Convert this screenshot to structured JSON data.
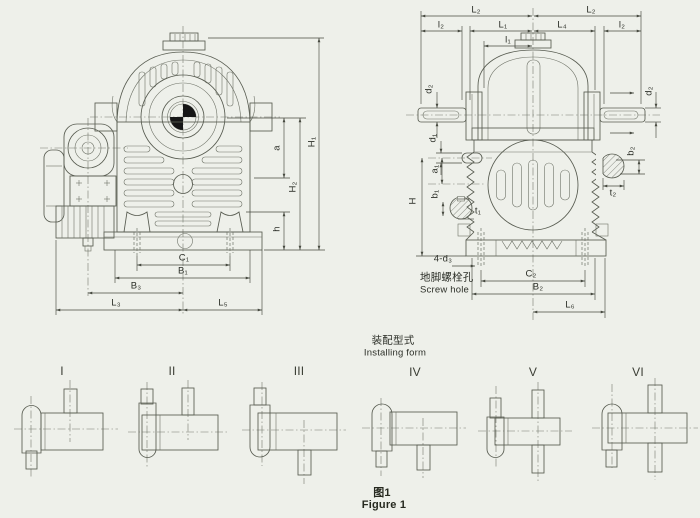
{
  "colors": {
    "background": "#eef0ea",
    "line": "#585c51",
    "dimension_line": "#474a40",
    "text": "#2c2f28",
    "centroid_fill": "#161616"
  },
  "front_view": {
    "dims": {
      "H1": "H₁",
      "H2": "H₂",
      "a": "a",
      "h": "h",
      "C1": "C₁",
      "B1": "B₁",
      "B3": "B₃",
      "L3": "L₃",
      "L5": "L₅"
    }
  },
  "side_view": {
    "dims": {
      "L2_left": "L₂",
      "L2_right": "L₂",
      "l2_left": "l₂",
      "L1": "L₁",
      "L4": "L₄",
      "l2_right": "l₂",
      "l1": "l₁",
      "d2_left": "d₂",
      "d2_right": "d₂",
      "d1": "d₁",
      "a1": "a₁",
      "b1": "b₁",
      "t1": "t₁",
      "H": "H",
      "b2": "b₂",
      "t2": "t₂",
      "C2": "C₂",
      "B2": "B₂",
      "L6": "L₆",
      "d3_note": "4-d₃"
    },
    "screw_hole_cn": "地脚螺栓孔",
    "screw_hole_en": "Screw hole"
  },
  "installing": {
    "title_cn": "装配型式",
    "title_en": "Installing form",
    "forms": [
      "I",
      "II",
      "III",
      "IV",
      "V",
      "VI"
    ]
  },
  "caption": {
    "cn": "图1",
    "en": "Figure 1"
  }
}
